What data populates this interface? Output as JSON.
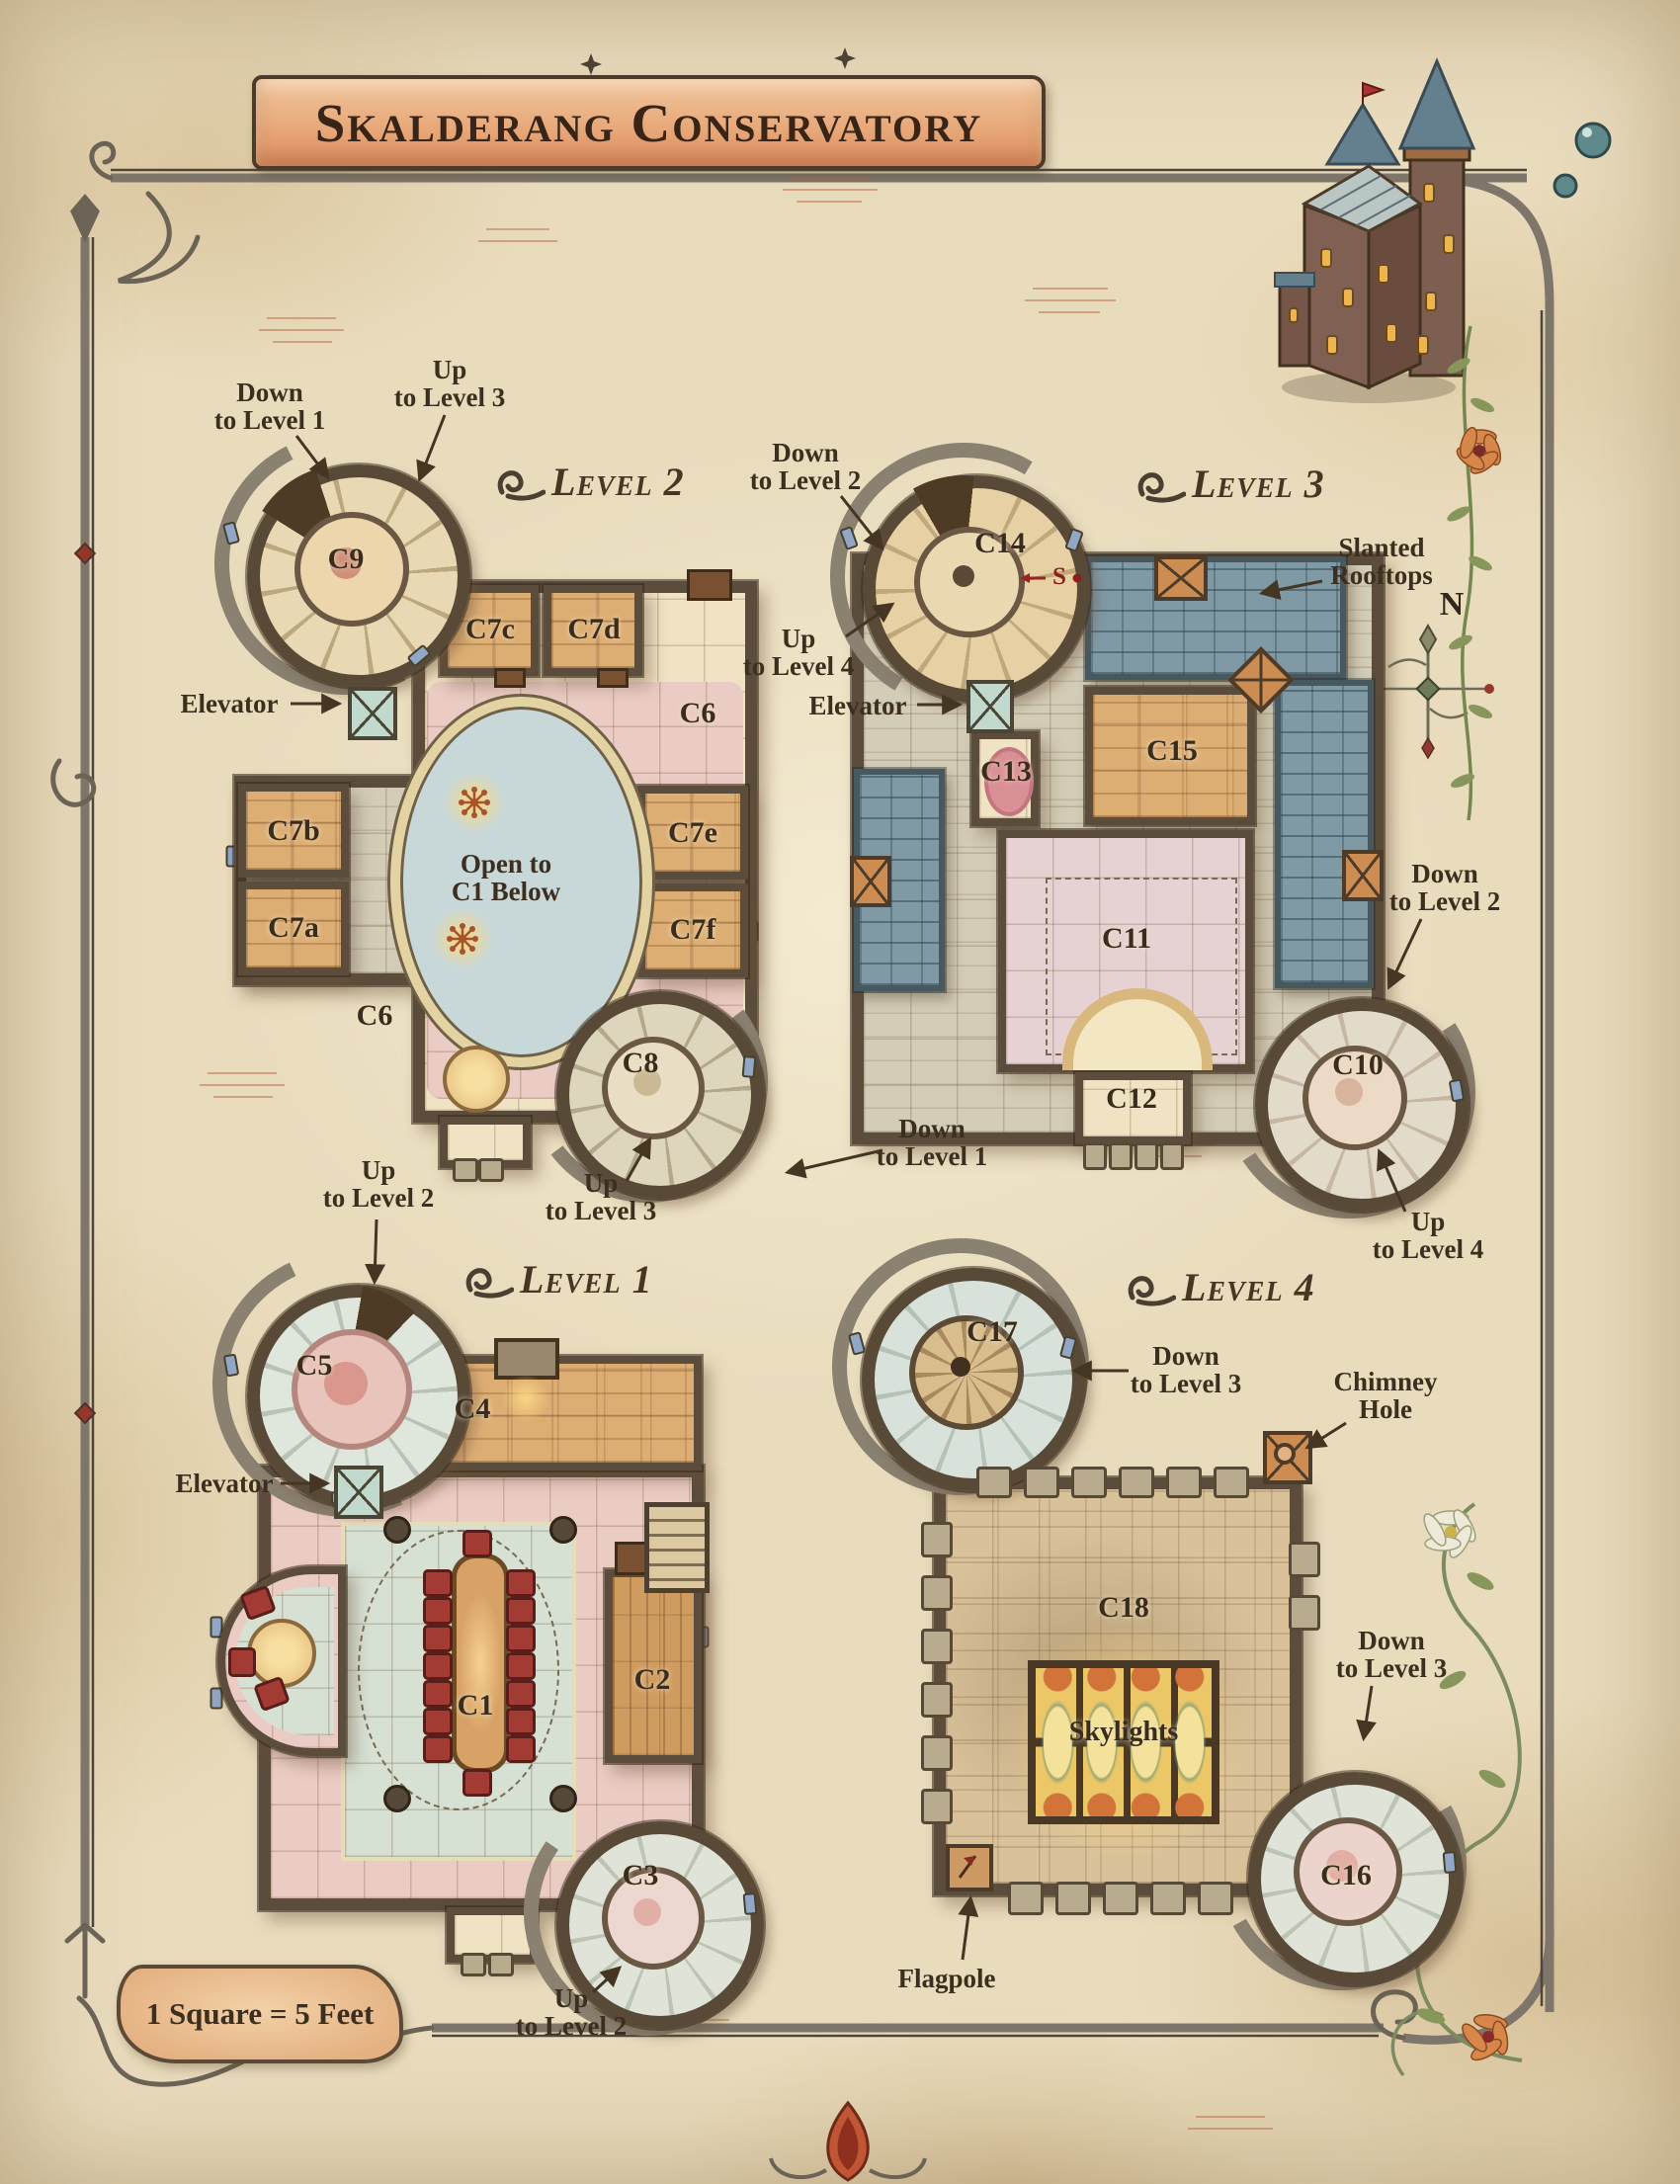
{
  "title": "Skalderang Conservatory",
  "scale_note": "1 Square = 5 Feet",
  "compass_n": "N",
  "secret_marker": "S",
  "palette": {
    "parchment": "#e9dcbd",
    "ink": "#3f3122",
    "banner_ribbon": "#e8a97a",
    "wall": "#5b4c3b",
    "roof_slate": "#7f99a5",
    "brick_floor": "#ddae74",
    "pink_floor": "#ebccc4",
    "teal_floor": "#d6e0d3",
    "stone_floor": "#d9c29a",
    "chair_red": "#a33b35",
    "elevator_teal": "#c2d9cd",
    "chimney_orange": "#cc8c52",
    "accent_red": "#96372c"
  },
  "levels": {
    "level1": {
      "header": "Level 1",
      "rooms": {
        "c1": "C1",
        "c2": "C2",
        "c3": "C3",
        "c4": "C4",
        "c5": "C5"
      },
      "labels": {
        "elevator": "Elevator",
        "up_to_level_2_tower_c5": "Up\nto Level 2",
        "up_to_level_2_tower_c3": "Up\nto Level 2"
      }
    },
    "level2": {
      "header": "Level 2",
      "rooms": {
        "c6_upper": "C6",
        "c6_lower": "C6",
        "c7a": "C7a",
        "c7b": "C7b",
        "c7c": "C7c",
        "c7d": "C7d",
        "c7e": "C7e",
        "c7f": "C7f",
        "c8": "C8",
        "c9": "C9"
      },
      "labels": {
        "open_below": "Open to\nC1 Below",
        "elevator": "Elevator",
        "down_to_level_1_tower_c9": "Down\nto Level 1",
        "up_to_level_3_tower_c9": "Up\nto Level 3",
        "up_to_level_3_tower_c8": "Up\nto Level 3",
        "down_to_level_1_tower_c8": "Down\nto Level 1"
      }
    },
    "level3": {
      "header": "Level 3",
      "rooms": {
        "c10": "C10",
        "c11": "C11",
        "c12": "C12",
        "c13": "C13",
        "c14": "C14",
        "c15": "C15"
      },
      "labels": {
        "elevator": "Elevator",
        "down_to_level_2_tower_c14": "Down\nto Level 2",
        "up_to_level_4_tower_c14": "Up\nto Level 4",
        "slanted_rooftops": "Slanted\nRooftops",
        "down_to_level_2_tower_c10": "Down\nto Level 2",
        "up_to_level_4_tower_c10": "Up\nto Level 4"
      }
    },
    "level4": {
      "header": "Level 4",
      "rooms": {
        "c16": "C16",
        "c17": "C17",
        "c18": "C18"
      },
      "labels": {
        "down_to_level_3_tower_c17": "Down\nto Level 3",
        "chimney_hole": "Chimney\nHole",
        "skylights": "Skylights",
        "down_to_level_3_tower_c16": "Down\nto Level 3",
        "flagpole": "Flagpole"
      }
    }
  }
}
